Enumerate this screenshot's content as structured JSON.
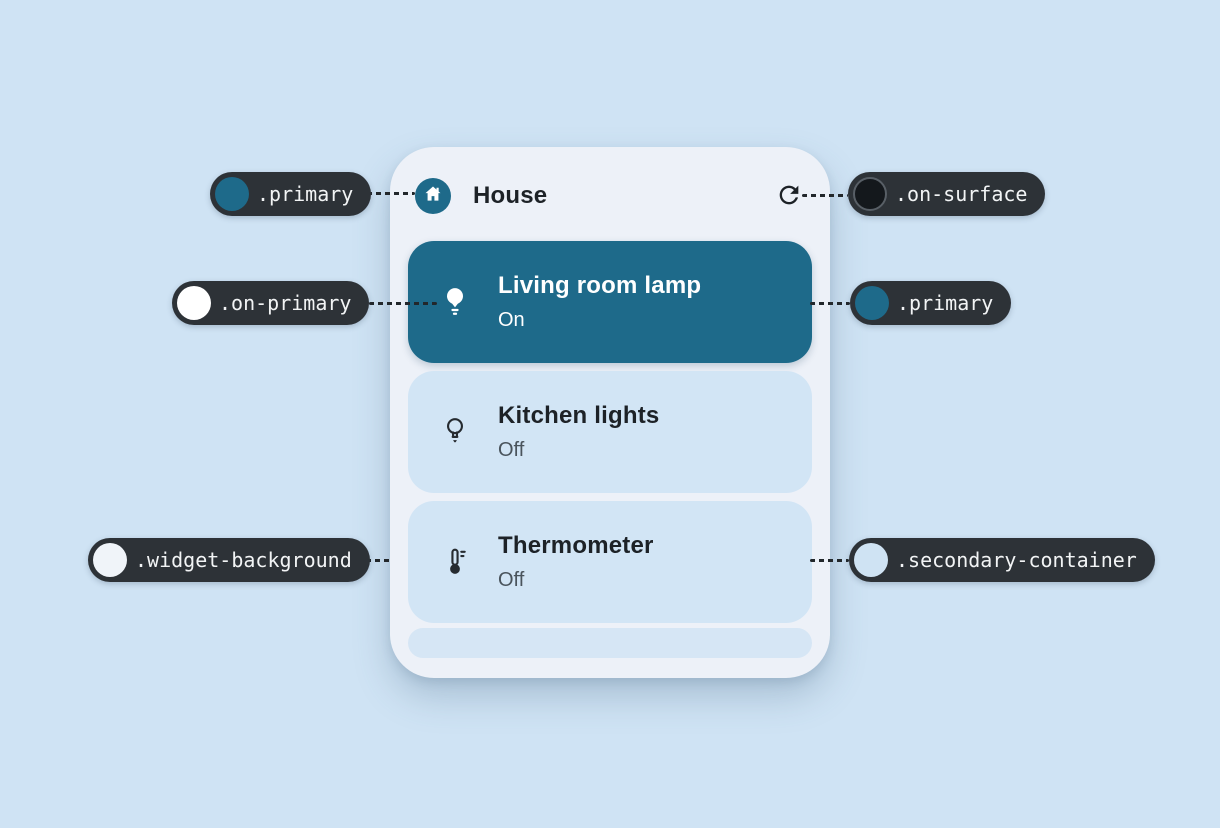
{
  "colors": {
    "page_background": "#cfe3f4",
    "widget_background": "#edf1f8",
    "primary": "#1e6a8a",
    "on_primary": "#ffffff",
    "secondary_container": "#d2e5f5",
    "on_surface": "#14181c",
    "callout_pill_background": "#2d3237",
    "callout_text": "#f2f4f5",
    "title_text": "#1d2227",
    "muted_status_text": "#4a545c"
  },
  "widget": {
    "header": {
      "title": "House",
      "icon": "house-icon",
      "action_icon": "refresh-icon"
    },
    "devices": [
      {
        "name": "Living room lamp",
        "status": "On",
        "icon": "lamp-filled-icon",
        "active": true
      },
      {
        "name": "Kitchen lights",
        "status": "Off",
        "icon": "lamp-outline-icon",
        "active": false
      },
      {
        "name": "Thermometer",
        "status": "Off",
        "icon": "thermometer-icon",
        "active": false
      }
    ]
  },
  "callouts": [
    {
      "id": "primary-top-left",
      "label": ".primary",
      "swatch_color": "#1e6a8a",
      "points_to": "house-icon-badge"
    },
    {
      "id": "on-surface",
      "label": ".on-surface",
      "swatch_color": "#14181c",
      "points_to": "refresh-icon"
    },
    {
      "id": "on-primary",
      "label": ".on-primary",
      "swatch_color": "#ffffff",
      "points_to": "lamp-filled-icon"
    },
    {
      "id": "primary-right",
      "label": ".primary",
      "swatch_color": "#1e6a8a",
      "points_to": "active-device-card"
    },
    {
      "id": "widget-background",
      "label": ".widget-background",
      "swatch_color": "#f0f4f9",
      "points_to": "widget-card"
    },
    {
      "id": "secondary-container",
      "label": ".secondary-container",
      "swatch_color": "#cfe3f3",
      "points_to": "idle-device-card"
    }
  ]
}
